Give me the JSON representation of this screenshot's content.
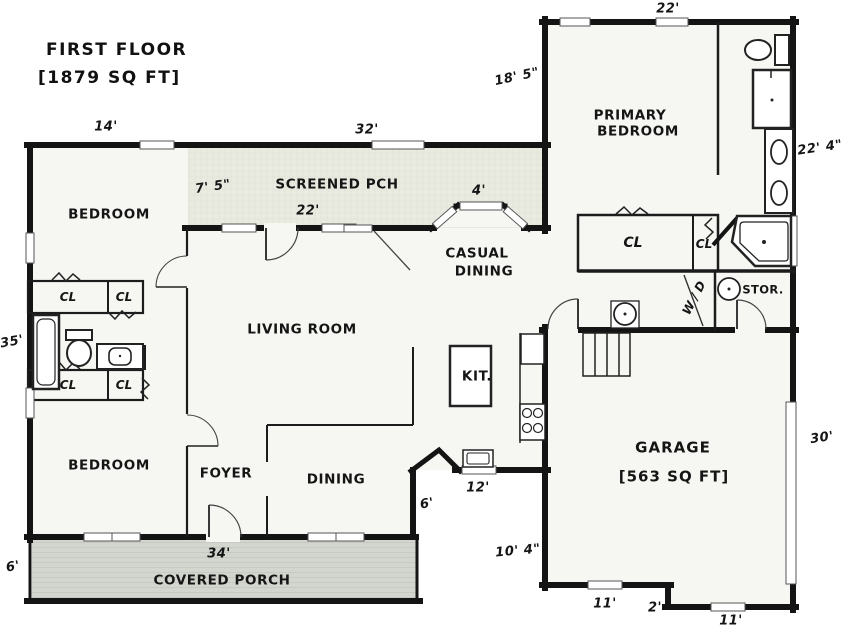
{
  "title": {
    "name": "FIRST FLOOR",
    "area": "[1879 SQ FT]"
  },
  "rooms": {
    "screened_porch": "SCREENED PCH",
    "primary_bedroom": [
      "PRIMARY",
      "BEDROOM"
    ],
    "bedroom_top": "BEDROOM",
    "bedroom_bottom": "BEDROOM",
    "casual_dining": [
      "CASUAL",
      "DINING"
    ],
    "living_room": "LIVING ROOM",
    "kitchen": "KIT.",
    "foyer": "FOYER",
    "dining": "DINING",
    "garage": "GARAGE",
    "garage_area": "[563 SQ FT]",
    "covered_porch": "COVERED PORCH",
    "storage": "STOR.",
    "washer_dryer": "W / D",
    "closets": [
      "CL",
      "CL",
      "CL",
      "CL",
      "CL",
      "CL"
    ]
  },
  "dimensions": {
    "bedroom_top_width": "14'",
    "screened_porch_width": "32'",
    "primary_width": "22'",
    "primary_left_height": "18' 5\"",
    "primary_right_height": "22' 4\"",
    "screened_porch_depth": "7' 5\"",
    "screened_porch_inner": "22'",
    "bay_window": "4'",
    "left_wall_height": "35'",
    "garage_right_wall": "30'",
    "kitchen_window": "12'",
    "dining_corner": "6'",
    "garage_left_lower": "10' 4\"",
    "covered_porch_width": "34'",
    "covered_porch_depth": "6'",
    "garage_bottom_left": "11'",
    "garage_step": "2'",
    "garage_bottom_right": "11'"
  },
  "colors": {
    "wall": "#141414",
    "floor": "#f6f7f2",
    "screened_porch_fill": "#e9ebe1",
    "covered_porch_fill": "#d3d5cf"
  }
}
